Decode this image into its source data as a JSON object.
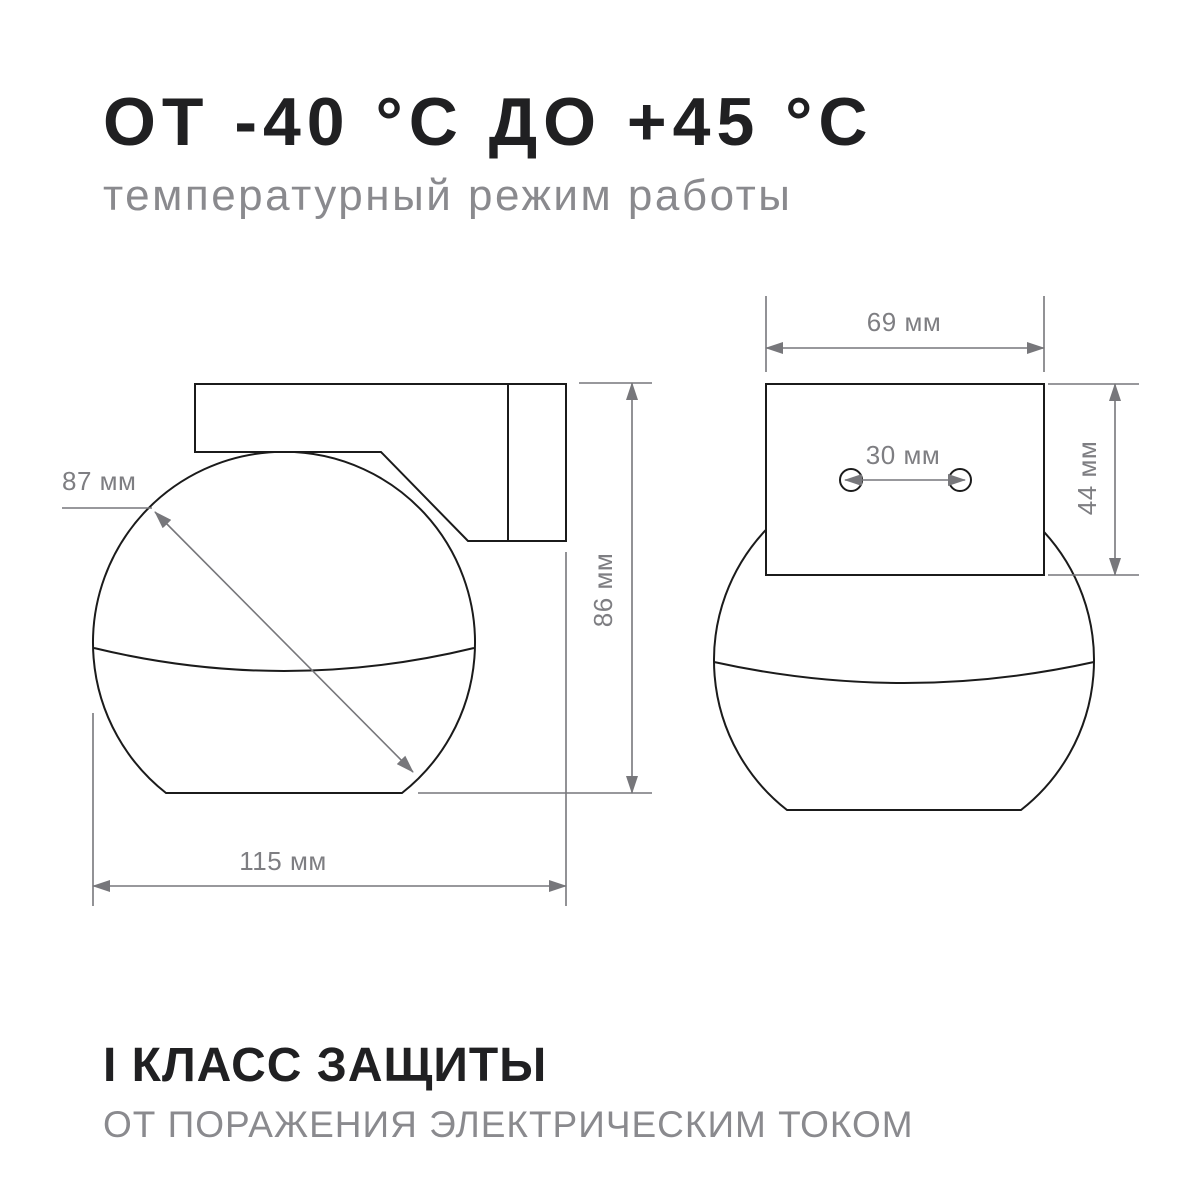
{
  "header": {
    "title": "ОТ -40 °С ДО +45 °С",
    "subtitle": "температурный режим работы"
  },
  "footer": {
    "title": "I КЛАСС ЗАЩИТЫ",
    "subtitle": "ОТ ПОРАЖЕНИЯ ЭЛЕКТРИЧЕСКИМ ТОКОМ"
  },
  "dimensions": {
    "side_view": {
      "sphere_diameter": "87 мм",
      "total_height": "86 мм",
      "total_width": "115 мм"
    },
    "front_view": {
      "bracket_width": "69 мм",
      "hole_spacing": "30 мм",
      "bracket_height": "44 мм"
    }
  },
  "colors": {
    "ink": "#202022",
    "sub": "#8a8a8e",
    "line": "#1b1b1b",
    "dim": "#77777b",
    "dimtext": "#7e7e82",
    "bg": "#ffffff"
  }
}
